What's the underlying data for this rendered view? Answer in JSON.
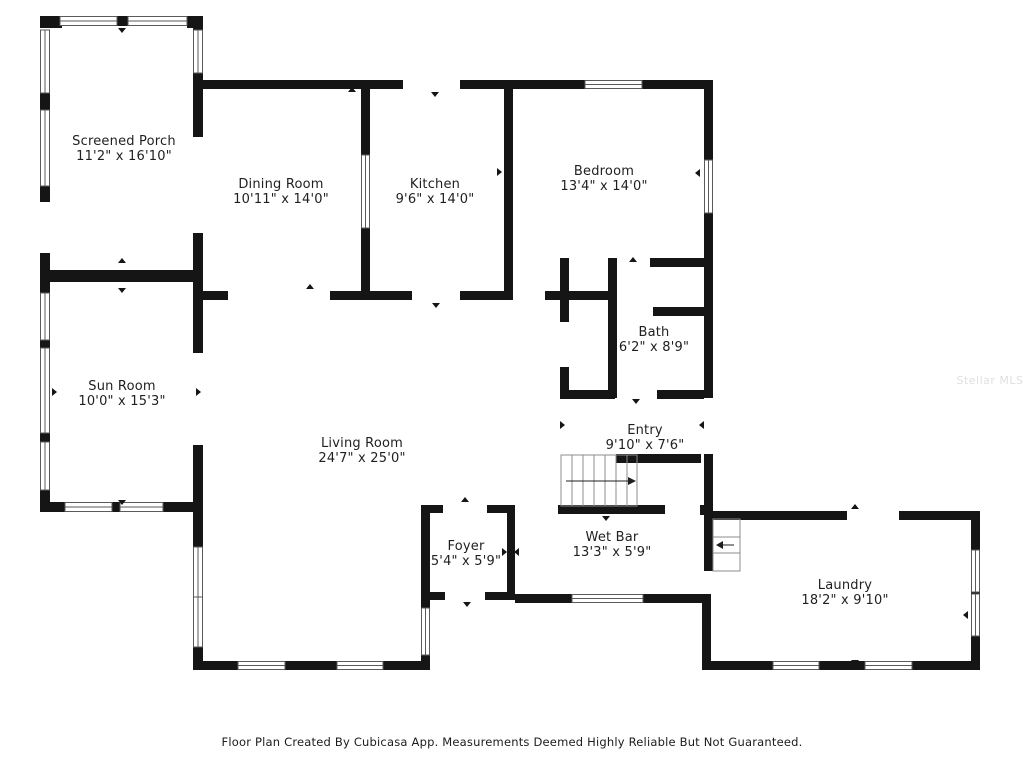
{
  "plan": {
    "rooms": [
      {
        "id": "screened-porch",
        "name": "Screened Porch",
        "dims": "11'2\" x 16'10\""
      },
      {
        "id": "dining-room",
        "name": "Dining Room",
        "dims": "10'11\" x 14'0\""
      },
      {
        "id": "kitchen",
        "name": "Kitchen",
        "dims": "9'6\" x 14'0\""
      },
      {
        "id": "bedroom",
        "name": "Bedroom",
        "dims": "13'4\" x 14'0\""
      },
      {
        "id": "bath",
        "name": "Bath",
        "dims": "6'2\" x 8'9\""
      },
      {
        "id": "sun-room",
        "name": "Sun Room",
        "dims": "10'0\" x 15'3\""
      },
      {
        "id": "living-room",
        "name": "Living Room",
        "dims": "24'7\" x 25'0\""
      },
      {
        "id": "entry",
        "name": "Entry",
        "dims": "9'10\" x 7'6\""
      },
      {
        "id": "foyer",
        "name": "Foyer",
        "dims": "5'4\" x 5'9\""
      },
      {
        "id": "wet-bar",
        "name": "Wet Bar",
        "dims": "13'3\" x 5'9\""
      },
      {
        "id": "laundry",
        "name": "Laundry",
        "dims": "18'2\" x 9'10\""
      }
    ],
    "footer": "Floor Plan Created By Cubicasa App. Measurements Deemed Highly Reliable But Not Guaranteed.",
    "watermark": "Stellar MLS",
    "colors": {
      "wall": "#151515",
      "window_frame": "#5a5a5a",
      "stair_line": "#8c8c8c",
      "text": "#1f1f1f"
    }
  }
}
